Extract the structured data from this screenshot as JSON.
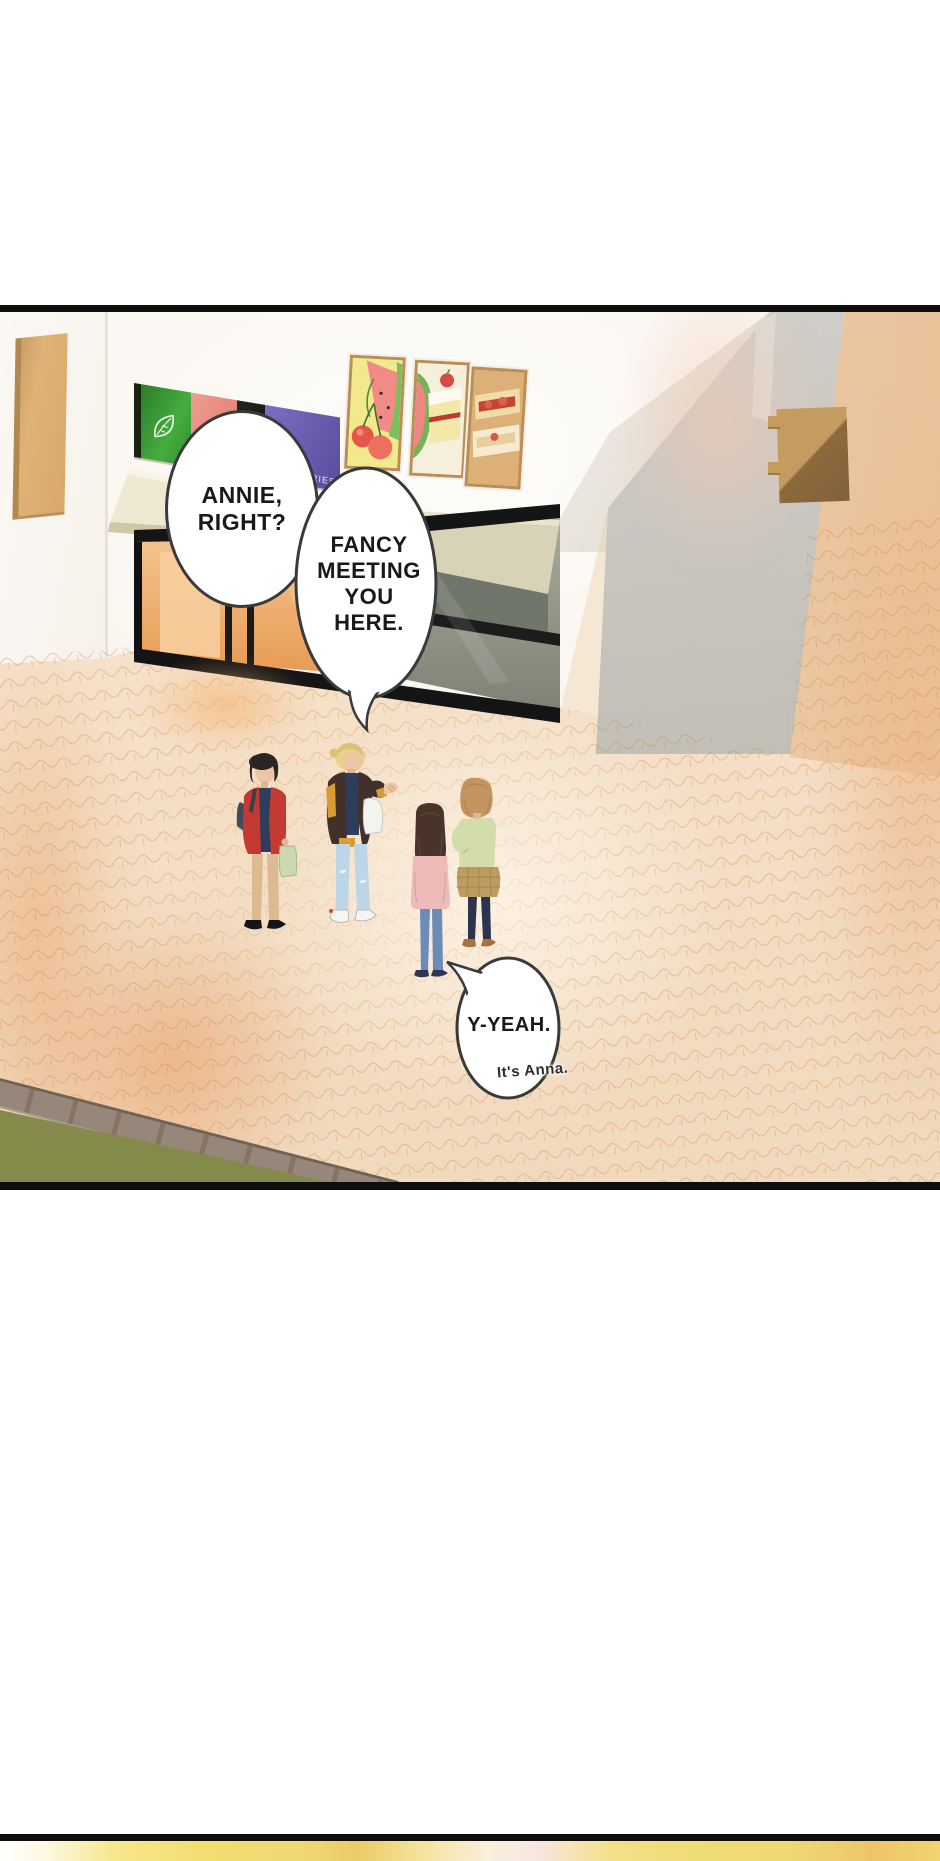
{
  "page": {
    "width": 940,
    "height": 1861,
    "background": "#ffffff",
    "kind": "webtoon comic page"
  },
  "panels": {
    "main": {
      "border_color": "#0e0e0e",
      "scene": "Four teens standing on a brick sidewalk in front of a pastry shop storefront",
      "storefront": {
        "banner_text_fragment": "ERIES",
        "posters": [
          "watermelon-and-cherries-poster",
          "watermelon-and-cake-poster",
          "jam-toast-poster"
        ]
      },
      "speech_bubbles": [
        {
          "id": "bubble-annie",
          "lines": [
            "ANNIE,",
            "RIGHT?"
          ]
        },
        {
          "id": "bubble-fancy",
          "lines": [
            "FANCY",
            "MEETING",
            "YOU",
            "HERE."
          ]
        },
        {
          "id": "bubble-yeah",
          "lines": [
            "Y-YEAH."
          ],
          "aside": "It's Anna."
        }
      ],
      "characters": [
        {
          "name": "boy-black-hair-red-jacket",
          "jacket": "#c23a32",
          "shirt": "#2f3d5c",
          "pants": "#dcba92",
          "bag": "#ccd8ae"
        },
        {
          "name": "boy-blonde-brown-jacket",
          "jacket": "#43302a",
          "accent": "#d99c33",
          "jeans": "#bcd6e8",
          "bag": "#f3f3f0"
        },
        {
          "name": "girl-long-hair-pink-sweater",
          "sweater": "#eebcb8",
          "jeans": "#6b8cb8",
          "hair": "#4a332a"
        },
        {
          "name": "girl-short-hair-green-sweater",
          "sweater": "#d3dcab",
          "skirt": "#bd9c60",
          "leggings": "#2d3450",
          "hair": "#c49460"
        }
      ]
    },
    "next": {
      "border_color": "#0e0e0e",
      "content": "yellow blurred top edge of next panel"
    }
  },
  "palette": {
    "bubble_outline": "#3a3a3a",
    "pavement": "#f5e1c9",
    "pavement_line": "#d0813c",
    "grass": "#8e9053",
    "awning": "#efe8d2",
    "banner_green": "#45ad3f",
    "banner_salmon": "#e2776a",
    "banner_purple": "#574c9e",
    "wall_gray": "#c8c6bf",
    "wall_peach": "#eeceab",
    "wood_sign": "#d9ab72",
    "door_glow": "#f0b072",
    "next_panel_yellow": "#f2dc6d"
  }
}
